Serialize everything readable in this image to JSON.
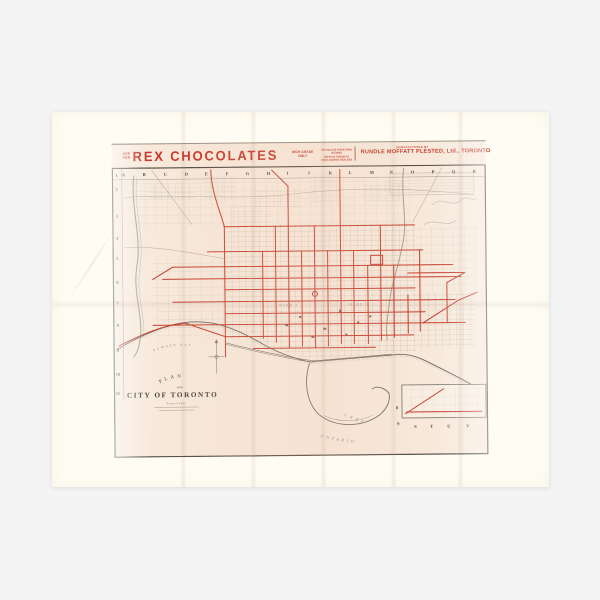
{
  "product": {
    "background_color": "#f4f4f5",
    "paper_color": "#fffdf3"
  },
  "header": {
    "ask_for_line1": "ASK",
    "ask_for_line2": "FOR",
    "brand": "REX CHOCOLATES",
    "grade_line1": "HIGH GRADE",
    "grade_line2": "ONLY",
    "fine_print_line1": "ON SALE IN THEIR OWN STORES",
    "fine_print_line2": "BOTH IN TORONTO",
    "fine_print_line3": "AND LEADING DEALERS",
    "manufactured_by": "MANUFACTURED BY",
    "manufacturer": "RUNDLE MOFFATT PLESTED, Ltd., TORONTO"
  },
  "map": {
    "grid_columns": [
      "A",
      "B",
      "C",
      "D",
      "E",
      "F",
      "G",
      "H",
      "I",
      "J",
      "K",
      "L",
      "M",
      "N",
      "O",
      "P",
      "Q",
      "R"
    ],
    "grid_rows": [
      "1",
      "2",
      "3",
      "4",
      "5",
      "6",
      "7",
      "8",
      "9",
      "10",
      "11"
    ],
    "grid_bottom_letters": [
      "S",
      "T",
      "U",
      "V"
    ],
    "inset_row_8": "8",
    "inset_row_9": "9",
    "title_arc": "PLAN",
    "title_of_the": "of the",
    "title_name": "CITY OF TORONTO",
    "scale_note": "Scale of Feet",
    "lake_word1": "LAKE",
    "lake_word2": "ONTARIO",
    "humber_bay": "HUMBER BAY",
    "ward_label_west": "WARD 4",
    "ward_label_east": "WARD 3",
    "colors": {
      "route_red": "#c43b2b",
      "header_red": "#c63425",
      "street_gray": "#b3afa2",
      "shoreline": "#6e695f",
      "print_background": "#f7e9db"
    }
  }
}
